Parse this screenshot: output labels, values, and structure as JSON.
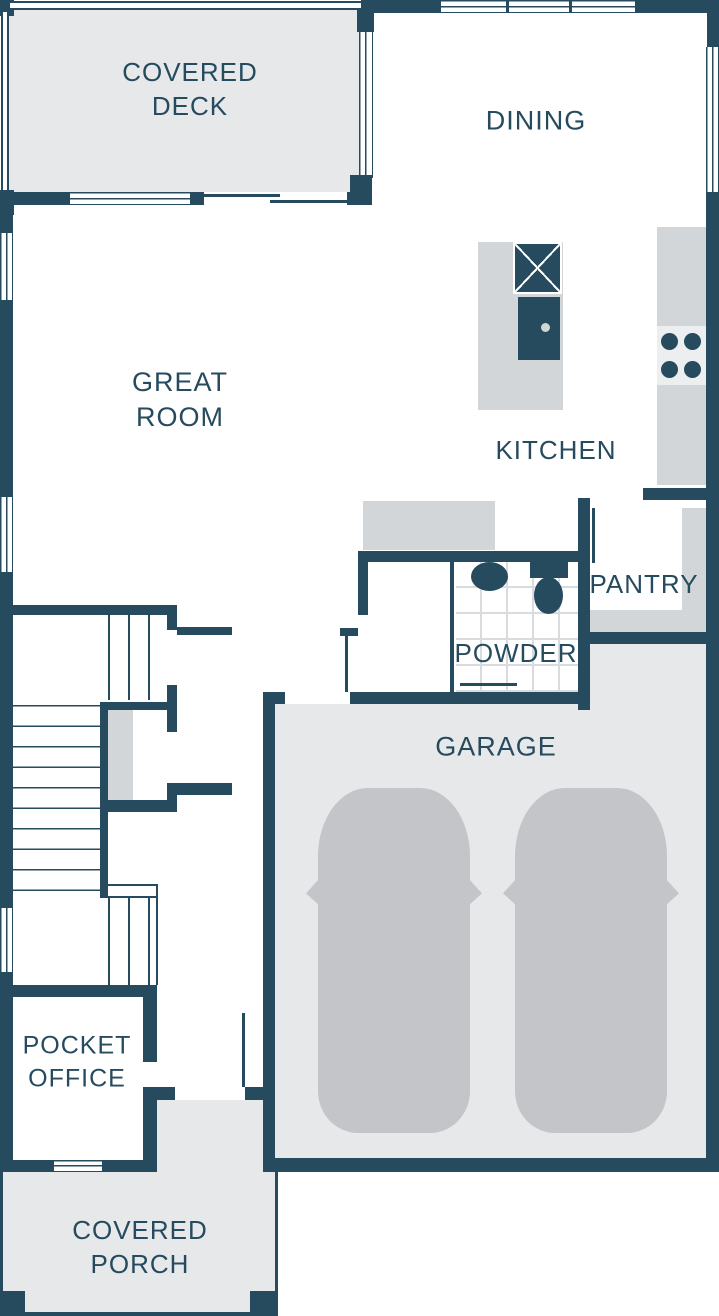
{
  "title": "Residential first-floor plan",
  "palette": {
    "wall": "#264a5e",
    "label_text": "#264a5e",
    "deck_floor": "#e6e8ea",
    "porch_floor": "#e6e8ea",
    "garage_floor": "#e6e8ea",
    "counter_gray": "#d3d6d8",
    "car_gray": "#c3c5c8",
    "cooktop_panel": "#edeef0",
    "tile_line": "#d9dcde"
  },
  "rooms": {
    "covered_deck": {
      "label": "COVERED\nDECK"
    },
    "dining": {
      "label": "DINING"
    },
    "great_room": {
      "label": "GREAT\nROOM"
    },
    "kitchen": {
      "label": "KITCHEN"
    },
    "pantry": {
      "label": "PANTRY"
    },
    "powder": {
      "label": "POWDER"
    },
    "garage": {
      "label": "GARAGE"
    },
    "pocket_office": {
      "label": "POCKET\nOFFICE"
    },
    "covered_porch": {
      "label": "COVERED\nPORCH"
    }
  },
  "fixtures": [
    "kitchen-island",
    "island-sink",
    "cooktop-4-burners",
    "powder-sink",
    "toilet",
    "stairs",
    "car",
    "car",
    "pantry-shelves"
  ]
}
